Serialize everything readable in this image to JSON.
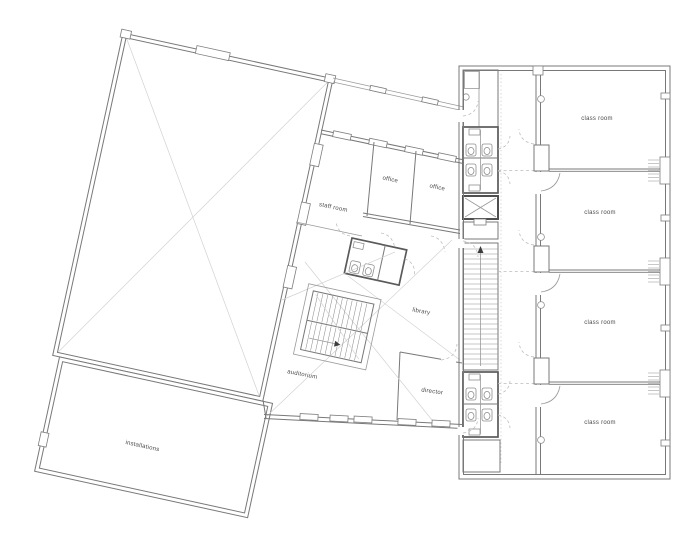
{
  "rooms": {
    "staff_room": {
      "label": "staff room"
    },
    "office_1": {
      "label": "office"
    },
    "office_2": {
      "label": "office"
    },
    "library": {
      "label": "library"
    },
    "auditorium": {
      "label": "auditorium"
    },
    "director": {
      "label": "director"
    },
    "installations": {
      "label": "installations"
    },
    "classroom_1": {
      "label": "class room"
    },
    "classroom_2": {
      "label": "class room"
    },
    "classroom_3": {
      "label": "class room"
    },
    "classroom_4": {
      "label": "class room"
    }
  },
  "drawing": {
    "line_color": "#787878",
    "background": "#ffffff",
    "rotation_left_wing_deg": 12.3
  }
}
